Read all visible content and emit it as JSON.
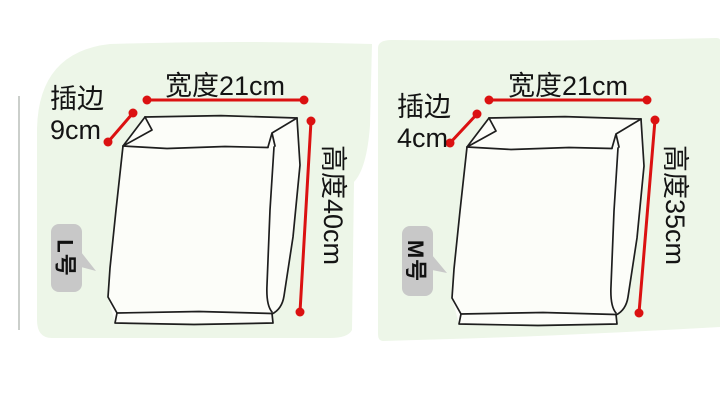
{
  "title": "bag-size-dimension-diagram",
  "colors": {
    "panel_green": "#edf6e8",
    "dimension_red": "#db1111",
    "outline_dark": "#1e1e1e",
    "bubble_gray": "#c8c8c8",
    "bag_fill_white": "#fcfdf9",
    "text_black": "#141414"
  },
  "panels": [
    {
      "size_label": "L号",
      "width_label": "宽度21cm",
      "gusset_line1": "插边",
      "gusset_line2": "9cm",
      "height_label": "高度40cm"
    },
    {
      "size_label": "M号",
      "width_label": "宽度21cm",
      "gusset_line1": "插边",
      "gusset_line2": "4cm",
      "height_label": "高度35cm"
    }
  ],
  "measurements": [
    {
      "size": "L",
      "width_cm": 21,
      "gusset_cm": 9,
      "height_cm": 40
    },
    {
      "size": "M",
      "width_cm": 21,
      "gusset_cm": 4,
      "height_cm": 35
    }
  ]
}
